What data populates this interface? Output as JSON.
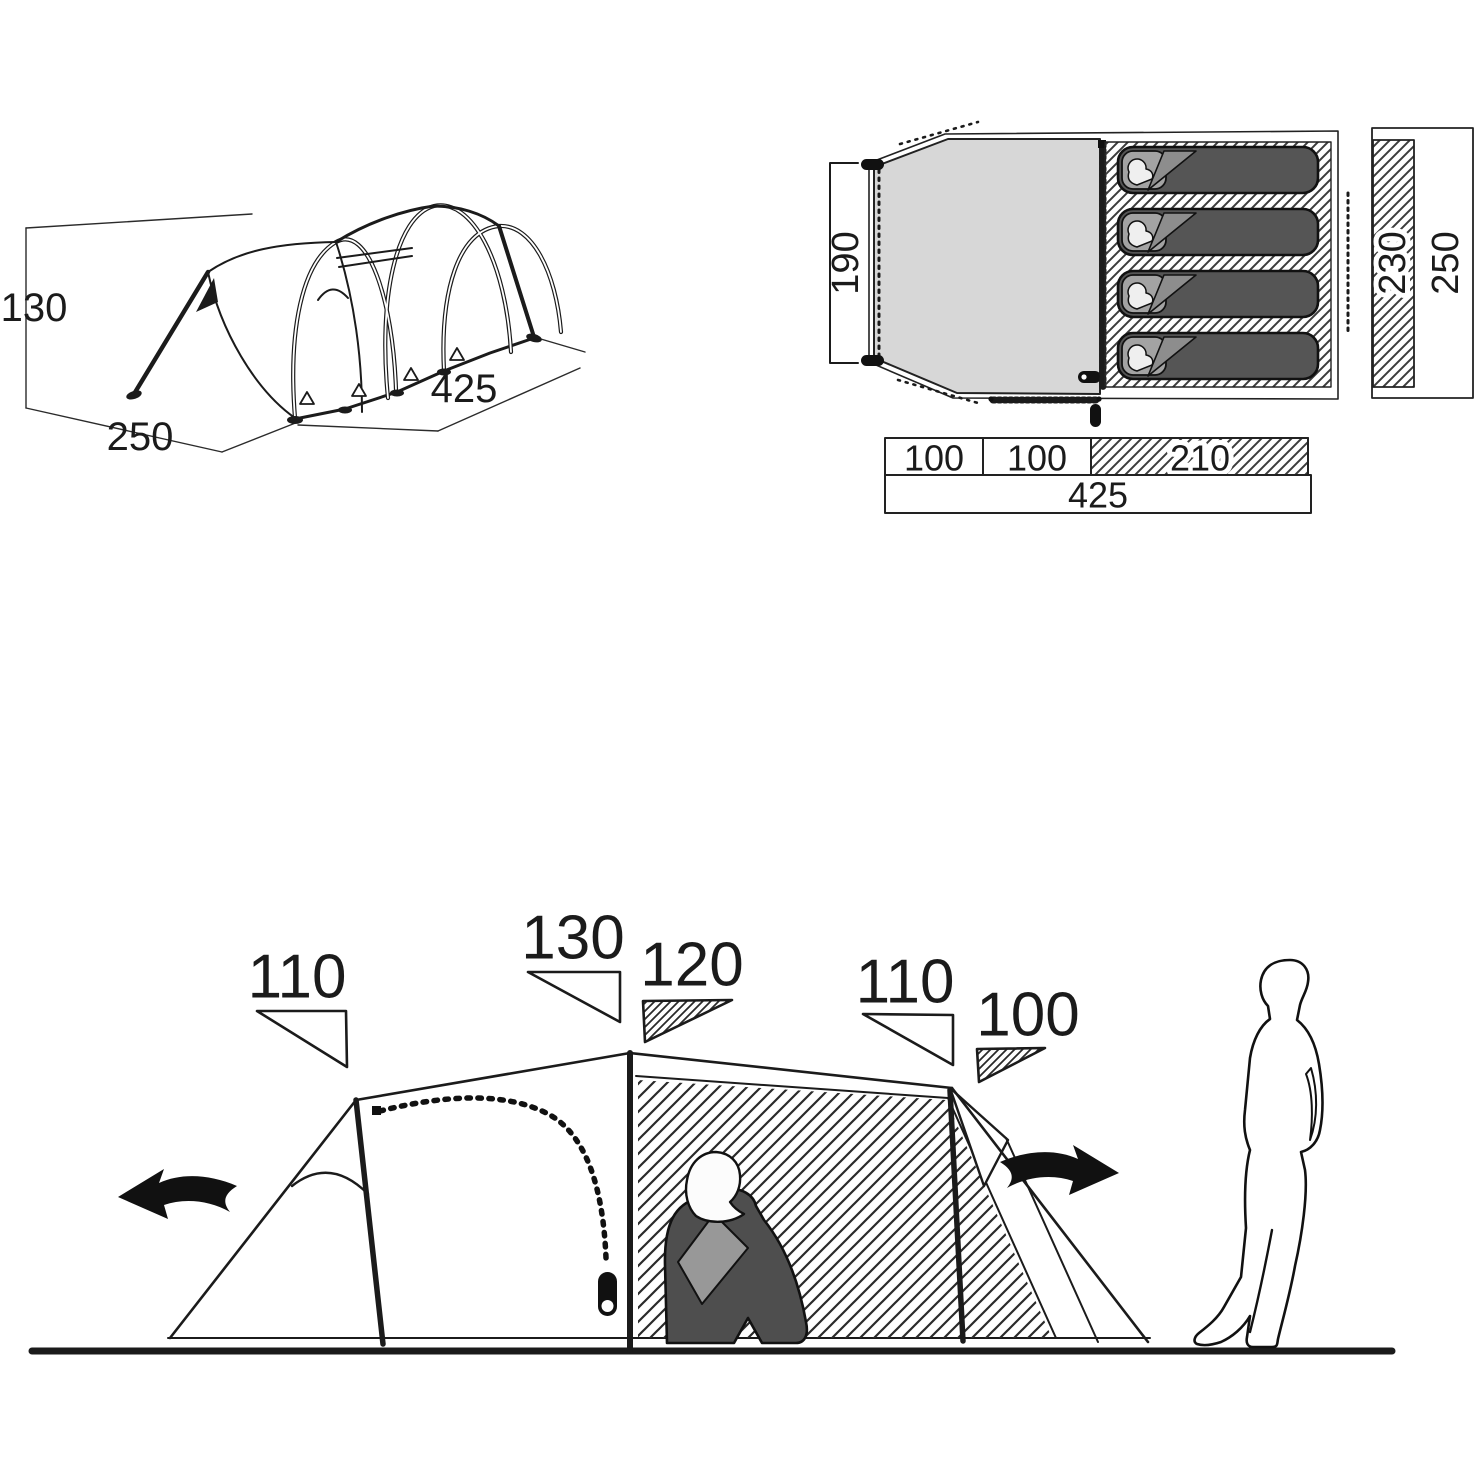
{
  "perspective_view": {
    "height": "130",
    "width": "250",
    "length": "425"
  },
  "floor_plan": {
    "porch_depth": "190",
    "inner_width": "230",
    "outer_width": "250",
    "length_segments": [
      "100",
      "100",
      "210"
    ],
    "total_length": "425",
    "sleeping_bag_count": 4
  },
  "elevation_view": {
    "heights": [
      "110",
      "130",
      "120",
      "110",
      "100"
    ]
  },
  "colors": {
    "line": "#1b1b1b",
    "porch_fill": "#d7d7d7",
    "sleeping_bag": "#555555",
    "bag_head_block": "#a3a3a3",
    "figure_blanket": "#4e4e4e",
    "figure_panel": "#989898",
    "background": "#ffffff"
  }
}
